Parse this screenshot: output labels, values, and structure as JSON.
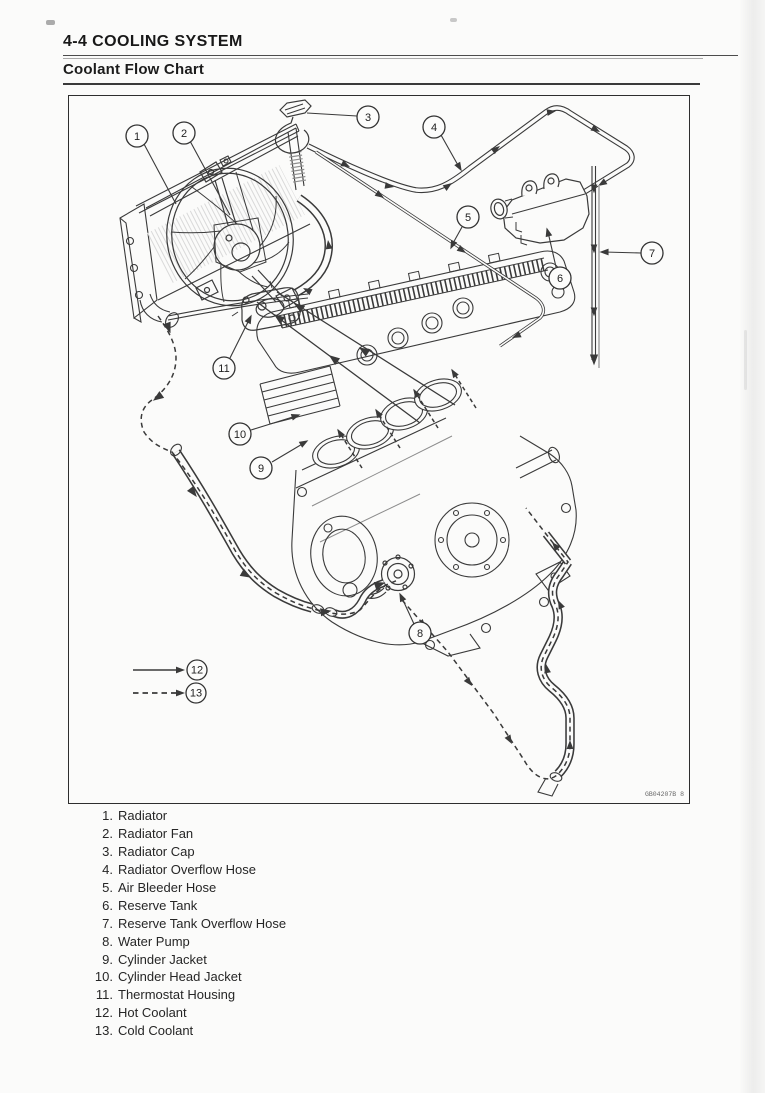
{
  "page": {
    "section_title": "4-4 COOLING SYSTEM",
    "subsection_title": "Coolant Flow Chart",
    "figure_code": "GB04207B  8"
  },
  "callouts": [
    "1",
    "2",
    "3",
    "4",
    "5",
    "6",
    "7",
    "8",
    "9",
    "10",
    "11",
    "12",
    "13"
  ],
  "legend_items": [
    {
      "num": "1.",
      "label": "Radiator"
    },
    {
      "num": "2.",
      "label": "Radiator Fan"
    },
    {
      "num": "3.",
      "label": "Radiator Cap"
    },
    {
      "num": "4.",
      "label": "Radiator Overflow Hose"
    },
    {
      "num": "5.",
      "label": "Air Bleeder Hose"
    },
    {
      "num": "6.",
      "label": "Reserve Tank"
    },
    {
      "num": "7.",
      "label": "Reserve Tank Overflow Hose"
    },
    {
      "num": "8.",
      "label": "Water Pump"
    },
    {
      "num": "9.",
      "label": "Cylinder Jacket"
    },
    {
      "num": "10.",
      "label": "Cylinder Head Jacket"
    },
    {
      "num": "11.",
      "label": "Thermostat Housing"
    },
    {
      "num": "12.",
      "label": "Hot Coolant"
    },
    {
      "num": "13.",
      "label": "Cold Coolant"
    }
  ],
  "flow_legend": [
    {
      "callout": "12",
      "line_style": "solid",
      "meaning": "Hot Coolant"
    },
    {
      "callout": "13",
      "line_style": "dashed",
      "meaning": "Cold Coolant"
    }
  ],
  "colors": {
    "line": "#3a3a3a",
    "background": "#fbfbfa",
    "text": "#262626"
  }
}
